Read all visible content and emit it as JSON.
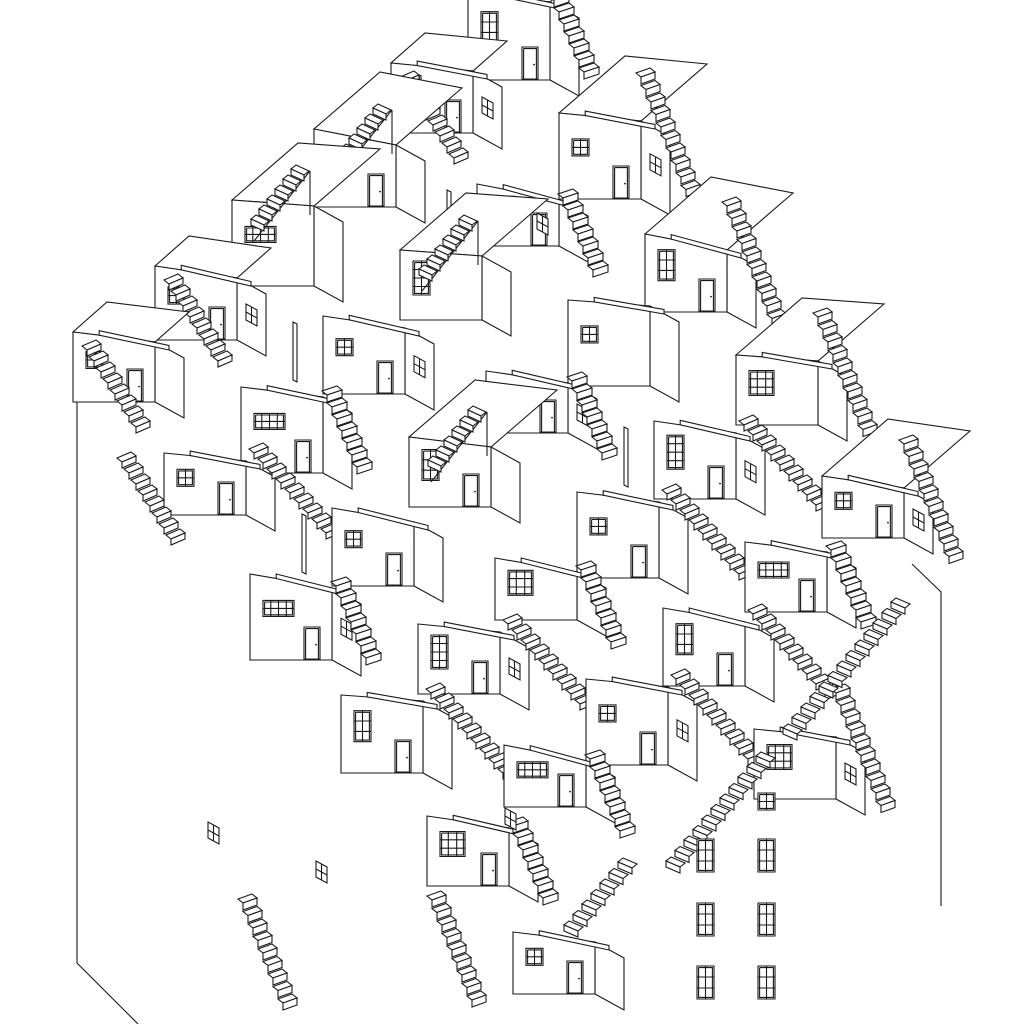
{
  "drawing": {
    "description": "axonometric-village-line-drawing",
    "canvas": {
      "w": 1024,
      "h": 1024,
      "bg": "#ffffff",
      "line": "#1a1a1a",
      "face": "#ffffff",
      "sw": 1.1
    },
    "lattice": {
      "origin": [
        470,
        -6
      ],
      "u": [
        -79,
        68
      ],
      "v": [
        88,
        120
      ]
    },
    "geom": {
      "s": 82,
      "depth": [
        29,
        16
      ],
      "top_back_full": [
        66,
        -57
      ],
      "top_back_left": [
        34,
        -30
      ],
      "slab": {
        "x0": 0.32,
        "over": 14,
        "rise": 8,
        "th": 4.5
      },
      "door": {
        "w": 16,
        "h": 32,
        "inset": 1.6,
        "from_right": 28
      },
      "post": {
        "x": -30,
        "y": 6,
        "w": 4,
        "h": 58
      },
      "iso_win": {
        "w": 11,
        "dy": 6,
        "h": 16
      }
    },
    "window_types": {
      "w2x2": {
        "w": 17,
        "h": 17,
        "cols": 2,
        "rows": 2
      },
      "w4x2": {
        "w": 31,
        "h": 16,
        "cols": 4,
        "rows": 2
      },
      "w2x3": {
        "w": 17,
        "h": 31,
        "cols": 2,
        "rows": 3
      },
      "w3x3": {
        "w": 25,
        "h": 25,
        "cols": 3,
        "rows": 3
      },
      "w2x4": {
        "w": 17,
        "h": 34,
        "cols": 2,
        "rows": 4
      },
      "w2x2f": {
        "w": 17,
        "h": 17,
        "cols": 2,
        "rows": 2
      },
      "w2x3f": {
        "w": 17,
        "h": 33,
        "cols": 2,
        "rows": 3
      }
    },
    "stair_types": {
      "flank": {
        "off": [
          5,
          12
        ],
        "tw": 15,
        "ta": 5,
        "rh": 7,
        "n": 7
      },
      "casc": {
        "off": [
          5,
          12.5
        ],
        "tw": 14,
        "ta": 5,
        "rh": 7,
        "n": 10
      },
      "diag": {
        "off": [
          9,
          10
        ],
        "tw": 14,
        "ta": 6,
        "rh": 6,
        "n": 9
      },
      "diagl": {
        "off": [
          7,
          11
        ],
        "tw": 14,
        "ta": 6,
        "rh": 6,
        "n": 8
      },
      "dl": {
        "off": [
          -9,
          10.5
        ],
        "tw": -14,
        "ta": 6,
        "rh": 6,
        "n": 9
      },
      "pit": {
        "off": [
          -8,
          10
        ],
        "tw": -13,
        "ta": 6,
        "rh": 6,
        "n": 6
      }
    },
    "stair_starts": {
      "flank": [
        4,
        -2
      ],
      "casc": [
        0,
        -44
      ],
      "diag": [
        8,
        -8
      ],
      "diagl_left": [
        14,
        18
      ],
      "pit": [
        36,
        -31
      ]
    },
    "cells": [
      {
        "i": 0,
        "j": 0,
        "h": 88,
        "ts": 10,
        "win": "w2x3",
        "wall": 0,
        "door": 1,
        "stair": "flank",
        "post": 0
      },
      {
        "i": 0,
        "j": 1,
        "h": 86,
        "ts": 8,
        "win": "w2x2",
        "wall": 1,
        "door": 1,
        "stair": "casc",
        "post": 0
      },
      {
        "i": 0,
        "j": 2,
        "h": 78,
        "ts": 16,
        "win": "w2x3",
        "wall": 0,
        "door": 1,
        "stair": "casc",
        "post": 0
      },
      {
        "i": 0,
        "j": 3,
        "h": 70,
        "ts": 6,
        "win": "w3x3",
        "wall": 0,
        "door": 0,
        "stair": "casc",
        "post": 0
      },
      {
        "i": 0,
        "j": 4,
        "h": 62,
        "ts": 12,
        "win": "w2x2",
        "wall": 1,
        "door": 1,
        "stair": "casc",
        "post": 0
      },
      {
        "i": 1,
        "j": 0,
        "h": 70,
        "ts": 8,
        "win": "w2x3",
        "wall": 1,
        "door": 1,
        "stair": "diag",
        "post": 0
      },
      {
        "i": 1,
        "j": 1,
        "h": 62,
        "ts": 16,
        "win": "w3x3",
        "wall": 0,
        "door": 1,
        "stair": "flank",
        "post": 1
      },
      {
        "i": 1,
        "j": 2,
        "h": 86,
        "ts": 6,
        "win": "w2x2",
        "wall": 0,
        "door": 0,
        "stair": "none",
        "post": 0
      },
      {
        "i": 1,
        "j": 3,
        "h": 78,
        "ts": 12,
        "win": "w2x4",
        "wall": 1,
        "door": 1,
        "stair": "diag",
        "post": 1
      },
      {
        "i": 1,
        "j": 4,
        "h": 70,
        "ts": 10,
        "win": "w4x2",
        "wall": 0,
        "door": 1,
        "stair": "flank",
        "post": 0
      },
      {
        "i": 2,
        "j": 0,
        "h": 78,
        "ts": 16,
        "win": "w2x2",
        "wall": 0,
        "door": 1,
        "stair": "pit",
        "post": 0
      },
      {
        "i": 2,
        "j": 1,
        "h": 70,
        "ts": 6,
        "win": "w2x4",
        "wall": 0,
        "door": 0,
        "stair": "pit",
        "post": 0
      },
      {
        "i": 2,
        "j": 2,
        "h": 62,
        "ts": 12,
        "win": "w4x2",
        "wall": 1,
        "door": 1,
        "stair": "flank",
        "post": 0
      },
      {
        "i": 2,
        "j": 3,
        "h": 86,
        "ts": 10,
        "win": "w2x2",
        "wall": 0,
        "door": 1,
        "stair": "diag",
        "post": 0
      },
      {
        "i": 2,
        "j": 4,
        "h": 78,
        "ts": 14,
        "win": "w2x3",
        "wall": 0,
        "door": 1,
        "stair": "diag",
        "post": 0
      },
      {
        "i": 2,
        "j": 5,
        "h": 70,
        "ts": 8,
        "win": "w3x3",
        "wall": 1,
        "door": 0,
        "stair": "casc",
        "post": 0
      },
      {
        "i": 3,
        "j": 0,
        "h": 86,
        "ts": 6,
        "win": "w4x2",
        "wall": 0,
        "door": 0,
        "stair": "pit",
        "post": 0
      },
      {
        "i": 3,
        "j": 1,
        "h": 78,
        "ts": 12,
        "win": "w2x2",
        "wall": 1,
        "door": 1,
        "stair": "none",
        "post": 1
      },
      {
        "i": 3,
        "j": 2,
        "h": 70,
        "ts": 10,
        "win": "w2x3",
        "wall": 0,
        "door": 1,
        "stair": "pit",
        "post": 0
      },
      {
        "i": 3,
        "j": 3,
        "h": 62,
        "ts": 14,
        "win": "w3x3",
        "wall": 0,
        "door": 0,
        "stair": "flank",
        "post": 0
      },
      {
        "i": 3,
        "j": 4,
        "h": 86,
        "ts": 8,
        "win": "w2x2",
        "wall": 1,
        "door": 1,
        "stair": "diag",
        "post": 0
      },
      {
        "i": 4,
        "j": 0,
        "h": 74,
        "ts": 12,
        "win": "w2x2",
        "wall": 1,
        "door": 1,
        "stair": "diag",
        "post": 0
      },
      {
        "i": 4,
        "j": 1,
        "h": 86,
        "ts": 10,
        "win": "w4x2",
        "wall": 0,
        "door": 1,
        "stair": "flank",
        "post": 0
      },
      {
        "i": 4,
        "j": 2,
        "h": 78,
        "ts": 14,
        "win": "w2x2",
        "wall": 0,
        "door": 1,
        "stair": "none",
        "post": 1
      },
      {
        "i": 4,
        "j": 3,
        "h": 70,
        "ts": 8,
        "win": "w2x4",
        "wall": 1,
        "door": 1,
        "stair": "diag",
        "post": 0
      },
      {
        "i": 4,
        "j": 4,
        "h": 62,
        "ts": 16,
        "win": "w4x2",
        "wall": 0,
        "door": 1,
        "stair": "flank",
        "post": 0
      },
      {
        "i": 5,
        "j": 0,
        "h": 70,
        "ts": 10,
        "win": "w2x2",
        "wall": 0,
        "door": 1,
        "stair": "diag",
        "post": 0
      },
      {
        "i": 5,
        "j": 1,
        "h": 62,
        "ts": 8,
        "win": "w2x2",
        "wall": 0,
        "door": 1,
        "stair": "diag",
        "post": 0
      },
      {
        "i": 5,
        "j": 2,
        "h": 86,
        "ts": 14,
        "win": "w4x2",
        "wall": 1,
        "door": 1,
        "stair": "flank",
        "post": 0
      },
      {
        "i": 5,
        "j": 3,
        "h": 78,
        "ts": 6,
        "win": "w2x3",
        "wall": 0,
        "door": 1,
        "stair": "diag",
        "post": 0
      },
      {
        "i": 5,
        "j": 4,
        "h": 70,
        "ts": 12,
        "win": "w3x3",
        "wall": 0,
        "door": 1,
        "stair": "flank",
        "post": 0
      },
      {
        "i": 5,
        "j": 5,
        "h": 62,
        "ts": 10,
        "win": "w2x2",
        "wall": 0,
        "door": 1,
        "stair": "none",
        "post": 0
      }
    ],
    "extra_stairs": [
      {
        "x": 905,
        "y": 608,
        "n": 13,
        "t": "dl"
      },
      {
        "x": 770,
        "y": 762,
        "n": 11,
        "t": "dl"
      },
      {
        "x": 632,
        "y": 868,
        "n": 7,
        "t": "dl"
      },
      {
        "x": 243,
        "y": 903,
        "n": 9,
        "t": "casc"
      },
      {
        "x": 432,
        "y": 900,
        "n": 9,
        "t": "casc"
      },
      {
        "x": 122,
        "y": 462,
        "n": 8,
        "t": "diagl"
      }
    ],
    "silhouette": [
      [
        [
          77,
          345
        ],
        [
          77,
          963
        ],
        [
          138,
          1024
        ]
      ],
      [
        [
          912,
          564
        ],
        [
          941,
          592
        ],
        [
          941,
          906
        ]
      ]
    ],
    "floating_windows": [
      {
        "t": "w2x2f",
        "x": 758,
        "y": 793
      },
      {
        "t": "w2x3f",
        "x": 697,
        "y": 839
      },
      {
        "t": "w2x3f",
        "x": 758,
        "y": 839
      },
      {
        "t": "w2x3f",
        "x": 697,
        "y": 903
      },
      {
        "t": "w2x3f",
        "x": 758,
        "y": 903
      },
      {
        "t": "w2x3f",
        "x": 697,
        "y": 966
      },
      {
        "t": "w2x3f",
        "x": 758,
        "y": 966
      }
    ],
    "floating_iso_windows": [
      {
        "x": 537,
        "y": 213
      },
      {
        "x": 208,
        "y": 822
      },
      {
        "x": 505,
        "y": 808
      },
      {
        "x": 316,
        "y": 861
      }
    ]
  }
}
